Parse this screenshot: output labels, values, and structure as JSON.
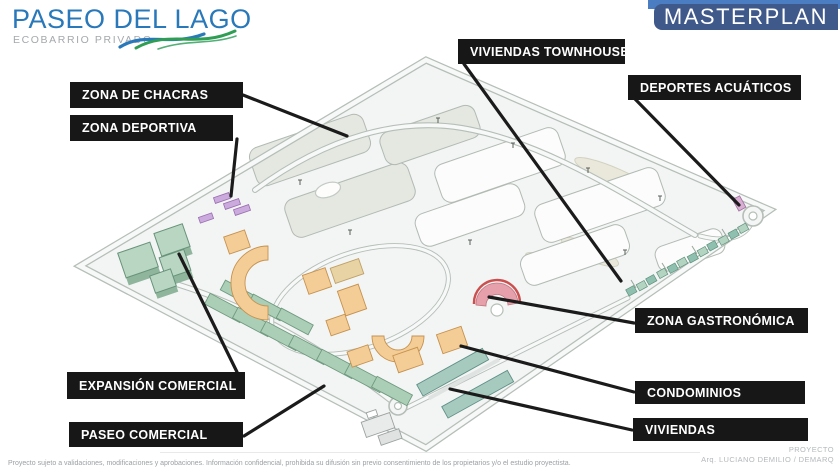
{
  "header": {
    "logo": {
      "title": "PASEO DEL LAGO",
      "subtitle": "ECOBARRIO PRIVADO"
    },
    "masterplan_label": "MASTERPLAN"
  },
  "labels": [
    {
      "id": "zona-de-chacras",
      "text": "ZONA DE CHACRAS"
    },
    {
      "id": "zona-deportiva",
      "text": "ZONA DEPORTIVA"
    },
    {
      "id": "viviendas-townhouse",
      "text": "VIVIENDAS TOWNHOUSE"
    },
    {
      "id": "deportes-acuaticos",
      "text": "DEPORTES ACUÁTICOS"
    },
    {
      "id": "expansion-comercial",
      "text": "EXPANSIÓN COMERCIAL"
    },
    {
      "id": "paseo-comercial",
      "text": "PASEO COMERCIAL"
    },
    {
      "id": "zona-gastronomica",
      "text": "ZONA GASTRONÓMICA"
    },
    {
      "id": "condominios",
      "text": "CONDOMINIOS"
    },
    {
      "id": "viviendas",
      "text": "VIVIENDAS"
    }
  ],
  "footer": {
    "disclaimer": "Proyecto sujeto a validaciones, modificaciones y aprobaciones. Información confidencial, prohibida su difusión sin previo consentimiento de los propietarios y/o el estudio proyectista.",
    "credit_label": "PROYECTO",
    "credit_name": "Arq. LUCIANO DEMILIO / DEMARQ"
  },
  "colors": {
    "title_blue": "#2878ba",
    "accent_bar_blue": "#4b7dc2",
    "masterplan_box_blue": "#40598b",
    "label_background": "#171717",
    "wave_green": "#2f9e54",
    "commercial_green": "#abceb7",
    "condo_orange": "#f4cd96",
    "sports_purple": "#cbaade",
    "gastro_pink": "#e5a0ab"
  }
}
